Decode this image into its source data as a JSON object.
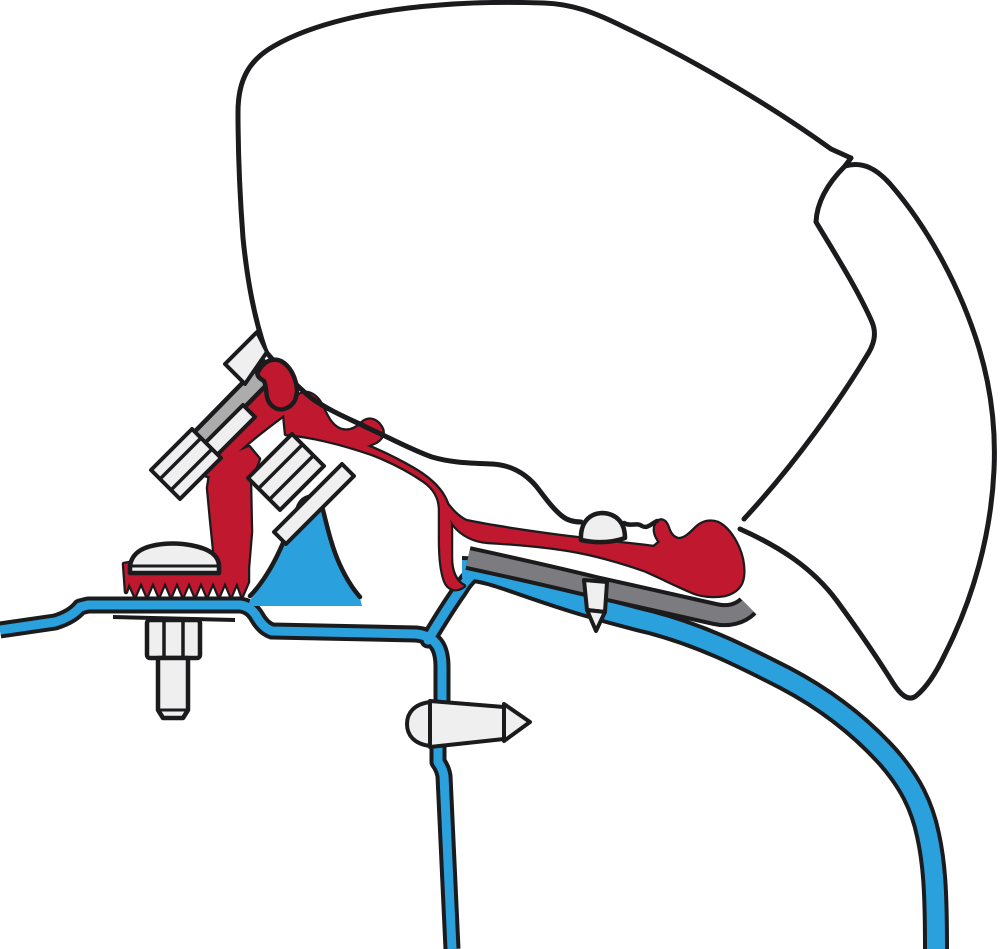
{
  "canvas": {
    "width": 1000,
    "height": 949
  },
  "colors": {
    "background": "#FFFFFF",
    "outline": "#1B1B1D",
    "bracket_red": "#C0182F",
    "roof_blue": "#2AA0DC",
    "rubber_gray": "#7C7C80",
    "plate_gray": "#ACACAC",
    "fastener_white": "#EFEFEF",
    "case_white": "#FFFFFF"
  },
  "figure": {
    "type": "technical-illustration",
    "parts": [
      {
        "id": "awning-case",
        "color": "case_white"
      },
      {
        "id": "awning-case-flap",
        "color": "case_white"
      },
      {
        "id": "adapter-bracket",
        "color": "bracket_red"
      },
      {
        "id": "adapter-rail-claw",
        "color": "bracket_red"
      },
      {
        "id": "serrated-clamp-foot",
        "color": "bracket_red"
      },
      {
        "id": "van-roof",
        "color": "roof_blue"
      },
      {
        "id": "roof-rib-hump",
        "color": "roof_blue"
      },
      {
        "id": "gutter-rail-and-wall",
        "color": "roof_blue"
      },
      {
        "id": "rubber-strip",
        "color": "rubber_gray"
      },
      {
        "id": "mounting-plate",
        "color": "plate_gray"
      },
      {
        "id": "hex-bolt-upper",
        "color": "fastener_white"
      },
      {
        "id": "hex-bolt-lower",
        "color": "fastener_white"
      },
      {
        "id": "dome-head-screw",
        "color": "fastener_white"
      },
      {
        "id": "hex-nut-and-stud",
        "color": "fastener_white"
      },
      {
        "id": "wall-rivet",
        "color": "fastener_white"
      },
      {
        "id": "roof-screw",
        "color": "fastener_white"
      }
    ]
  }
}
